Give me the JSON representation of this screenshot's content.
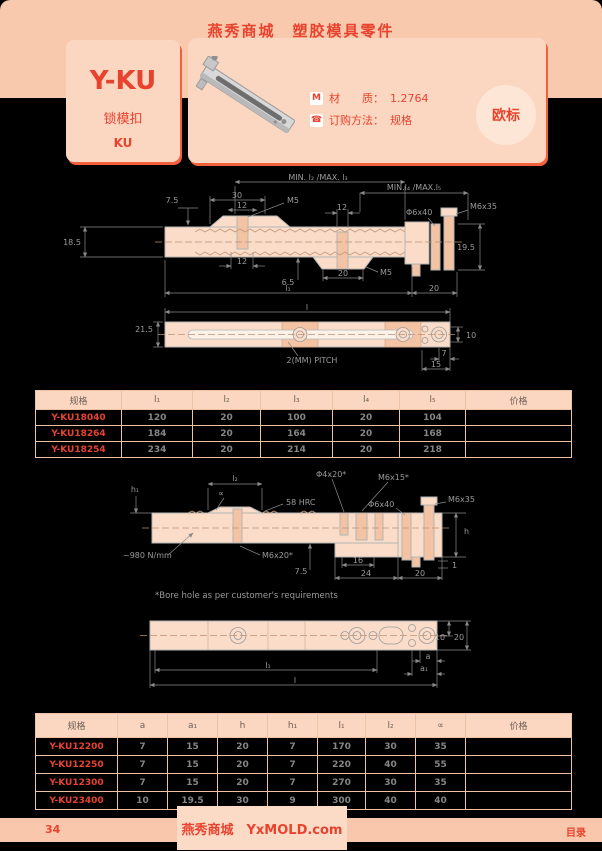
{
  "colors": {
    "band": "#f9c9ae",
    "card": "#fbd7c2",
    "accent": "#e8432e",
    "table_border": "#f0c2a4",
    "row_bg": "#000000",
    "dim_text": "#9a9a9a"
  },
  "header": {
    "title": "燕秀商城　塑胶模具零件"
  },
  "product": {
    "series": "Y-KU",
    "name_cn": "锁模扣",
    "code": "KU",
    "material_icon": "M",
    "material_label": "材　　质：",
    "material_value": "1.2764",
    "order_label": "订购方法：",
    "order_value": "规格",
    "badge": "欧标"
  },
  "drawing1": {
    "labels": {
      "min_max_23": "MIN. l₂ /MAX. l₃",
      "dim_30": "30",
      "dim_12_top": "12",
      "m5_top": "M5",
      "dim_75": "7.5",
      "min_max_45": "MIN.l₄ /MAX.l₅",
      "dim_12_mid": "12",
      "phi6x40": "Φ6x40",
      "m6x35": "M6x35",
      "dim_185": "18.5",
      "dim_195": "19.5",
      "dim_12_bot": "12",
      "dim_65": "6.5",
      "dim_20_boss": "20",
      "m5_bot": "M5",
      "l1": "l₁",
      "dim_20_right": "20",
      "l": "l",
      "dim_215": "21.5",
      "dim_10": "10",
      "pitch": "2(MM) PITCH",
      "dim_7": "7",
      "dim_15": "15"
    }
  },
  "table1": {
    "headers": [
      "规格",
      "l₁",
      "l₂",
      "l₃",
      "l₄",
      "l₅",
      "价格"
    ],
    "rows": [
      {
        "spec": "Y-KU18040",
        "values": [
          "120",
          "20",
          "100",
          "20",
          "104"
        ]
      },
      {
        "spec": "Y-KU18264",
        "values": [
          "184",
          "20",
          "164",
          "20",
          "168"
        ]
      },
      {
        "spec": "Y-KU18254",
        "values": [
          "234",
          "20",
          "214",
          "20",
          "218"
        ]
      }
    ]
  },
  "drawing2": {
    "labels": {
      "h1": "h₁",
      "l2": "l₂",
      "alpha": "∝",
      "hrc": "58 HRC",
      "phi4x20": "Φ4x20*",
      "m6x15": "M6x15*",
      "phi6x40": "Φ6x40",
      "m6x35": "M6x35",
      "force": "~980 N/mm",
      "m6x20": "M6x20*",
      "dim_75": "7.5",
      "dim_16": "16",
      "dim_24": "24",
      "dim_20": "20",
      "h": "h",
      "dim_1": "1",
      "note": "*Bore hole as per customer's requirements",
      "dim_10": "10",
      "dim_20b": "20",
      "a": "a",
      "a1": "a₁",
      "l1": "l₁",
      "l": "l"
    }
  },
  "table2": {
    "headers": [
      "规格",
      "a",
      "a₁",
      "h",
      "h₁",
      "l₁",
      "l₂",
      "∝",
      "价格"
    ],
    "rows": [
      {
        "spec": "Y-KU12200",
        "values": [
          "7",
          "15",
          "20",
          "7",
          "170",
          "30",
          "35"
        ]
      },
      {
        "spec": "Y-KU12250",
        "values": [
          "7",
          "15",
          "20",
          "7",
          "220",
          "40",
          "55"
        ]
      },
      {
        "spec": "Y-KU12300",
        "values": [
          "7",
          "15",
          "20",
          "7",
          "270",
          "30",
          "35"
        ]
      },
      {
        "spec": "Y-KU23400",
        "values": [
          "10",
          "19.5",
          "30",
          "9",
          "300",
          "40",
          "40"
        ]
      }
    ]
  },
  "footer": {
    "page": "34",
    "brand": "燕秀商城　YxMOLD.com",
    "toc": "目录"
  }
}
